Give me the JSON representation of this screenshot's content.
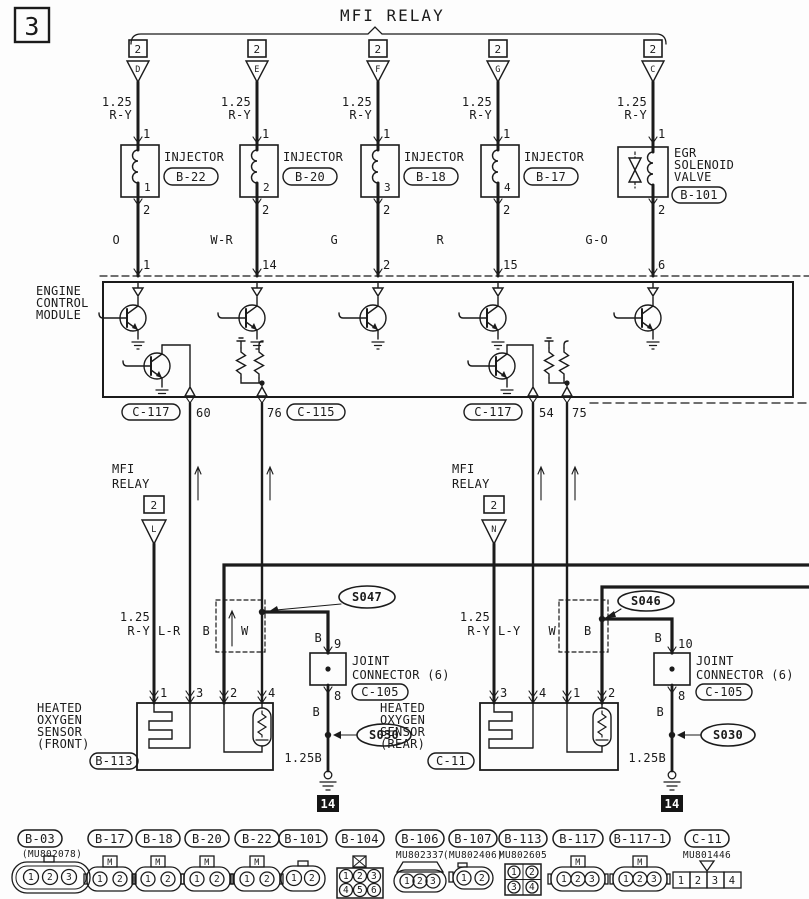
{
  "sheet_number": "3",
  "colors": {
    "ink": "#1b1b1b",
    "paper": "#fdfdfd"
  },
  "top": {
    "title": "MFI RELAY",
    "branches": [
      {
        "pin_box": "2",
        "terminal": "D",
        "size": "1.25",
        "color": "R-Y",
        "pin_top": "1",
        "internal": "1",
        "labels": [
          "INJECTOR"
        ],
        "code": "B-22",
        "pin_bottom": "2",
        "wire_color": "O",
        "ecm_pin": "1"
      },
      {
        "pin_box": "2",
        "terminal": "E",
        "size": "1.25",
        "color": "R-Y",
        "pin_top": "1",
        "internal": "2",
        "labels": [
          "INJECTOR"
        ],
        "code": "B-20",
        "pin_bottom": "2",
        "wire_color": "W-R",
        "ecm_pin": "14"
      },
      {
        "pin_box": "2",
        "terminal": "F",
        "size": "1.25",
        "color": "R-Y",
        "pin_top": "1",
        "internal": "3",
        "labels": [
          "INJECTOR"
        ],
        "code": "B-18",
        "pin_bottom": "2",
        "wire_color": "G",
        "ecm_pin": "2"
      },
      {
        "pin_box": "2",
        "terminal": "G",
        "size": "1.25",
        "color": "R-Y",
        "pin_top": "1",
        "internal": "4",
        "labels": [
          "INJECTOR"
        ],
        "code": "B-17",
        "pin_bottom": "2",
        "wire_color": "R",
        "ecm_pin": "15"
      },
      {
        "pin_box": "2",
        "terminal": "C",
        "size": "1.25",
        "color": "R-Y",
        "pin_top": "1",
        "labels": [
          "EGR",
          "SOLENOID",
          "VALVE"
        ],
        "code": "B-101",
        "pin_bottom": "2",
        "wire_color": "G-O",
        "ecm_pin": "6"
      }
    ]
  },
  "ecm": {
    "label": [
      "ENGINE",
      "CONTROL",
      "MODULE"
    ],
    "out1_code": "C-117",
    "out1_pin": "60",
    "out2_pin": "76",
    "out2_code": "C-115",
    "out3_code": "C-117",
    "out3_pin": "54",
    "out4_pin": "75"
  },
  "mid": {
    "left_relay": {
      "l1": "MFI",
      "l2": "RELAY",
      "pin": "2",
      "terminal": "L"
    },
    "right_relay": {
      "l1": "MFI",
      "l2": "RELAY",
      "pin": "2",
      "terminal": "N"
    },
    "left": {
      "size": "1.25",
      "color": "R-Y",
      "w2": "L-R",
      "w3": "B",
      "w4": "W",
      "splice": "S047"
    },
    "right": {
      "size": "1.25",
      "color": "R-Y",
      "w2": "L-Y",
      "w3": "W",
      "w4": "B",
      "splice": "S046"
    }
  },
  "joints": {
    "left": {
      "wire_in": "B",
      "pin_in": "9",
      "l1": "JOINT",
      "l2": "CONNECTOR (6)",
      "code": "C-105",
      "pin_out": "8",
      "wire_out": "B",
      "splice": "S030",
      "gnd_wire": "1.25B",
      "gnd": "14"
    },
    "right": {
      "wire_in": "B",
      "pin_in": "10",
      "l1": "JOINT",
      "l2": "CONNECTOR (6)",
      "code": "C-105",
      "pin_out": "8",
      "wire_out": "B",
      "splice": "S030",
      "gnd_wire": "1.25B",
      "gnd": "14"
    }
  },
  "sensors": {
    "front": {
      "l1": "HEATED",
      "l2": "OXYGEN",
      "l3": "SENSOR",
      "l4": "(FRONT)",
      "code": "B-113",
      "pins": [
        "1",
        "3",
        "2",
        "4"
      ]
    },
    "rear": {
      "l1": "HEATED",
      "l2": "OXYGEN",
      "l3": "SENSOR",
      "l4": "(REAR)",
      "code": "C-11",
      "pins": [
        "3",
        "4",
        "1",
        "2"
      ]
    }
  },
  "connectors": [
    {
      "code": "B-03",
      "part": "(MU802078)",
      "pins": [
        "1",
        "2",
        "3"
      ]
    },
    {
      "code": "B-17",
      "tab": "M",
      "pins": [
        "1",
        "2"
      ]
    },
    {
      "code": "B-18",
      "tab": "M",
      "pins": [
        "1",
        "2"
      ]
    },
    {
      "code": "B-20",
      "tab": "M",
      "pins": [
        "1",
        "2"
      ]
    },
    {
      "code": "B-22",
      "tab": "M",
      "pins": [
        "1",
        "2"
      ]
    },
    {
      "code": "B-101",
      "pins": [
        "1",
        "2"
      ]
    },
    {
      "code": "B-104",
      "pins": [
        "1",
        "2",
        "3",
        "4",
        "5",
        "6"
      ]
    },
    {
      "code": "B-106",
      "part": "MU802337",
      "pins": [
        "1",
        "2",
        "3"
      ]
    },
    {
      "code": "B-107",
      "part": "(MU802406)",
      "pins": [
        "1",
        "2"
      ]
    },
    {
      "code": "B-113",
      "part": "MU802605",
      "pins": [
        "1",
        "2",
        "3",
        "4"
      ]
    },
    {
      "code": "B-117",
      "tab": "M",
      "pins": [
        "1",
        "2",
        "3"
      ]
    },
    {
      "code": "B-117-1",
      "tab": "M",
      "pins": [
        "1",
        "2",
        "3"
      ]
    },
    {
      "code": "C-11",
      "part": "MU801446",
      "pins": [
        "1",
        "2",
        "3",
        "4"
      ]
    }
  ]
}
